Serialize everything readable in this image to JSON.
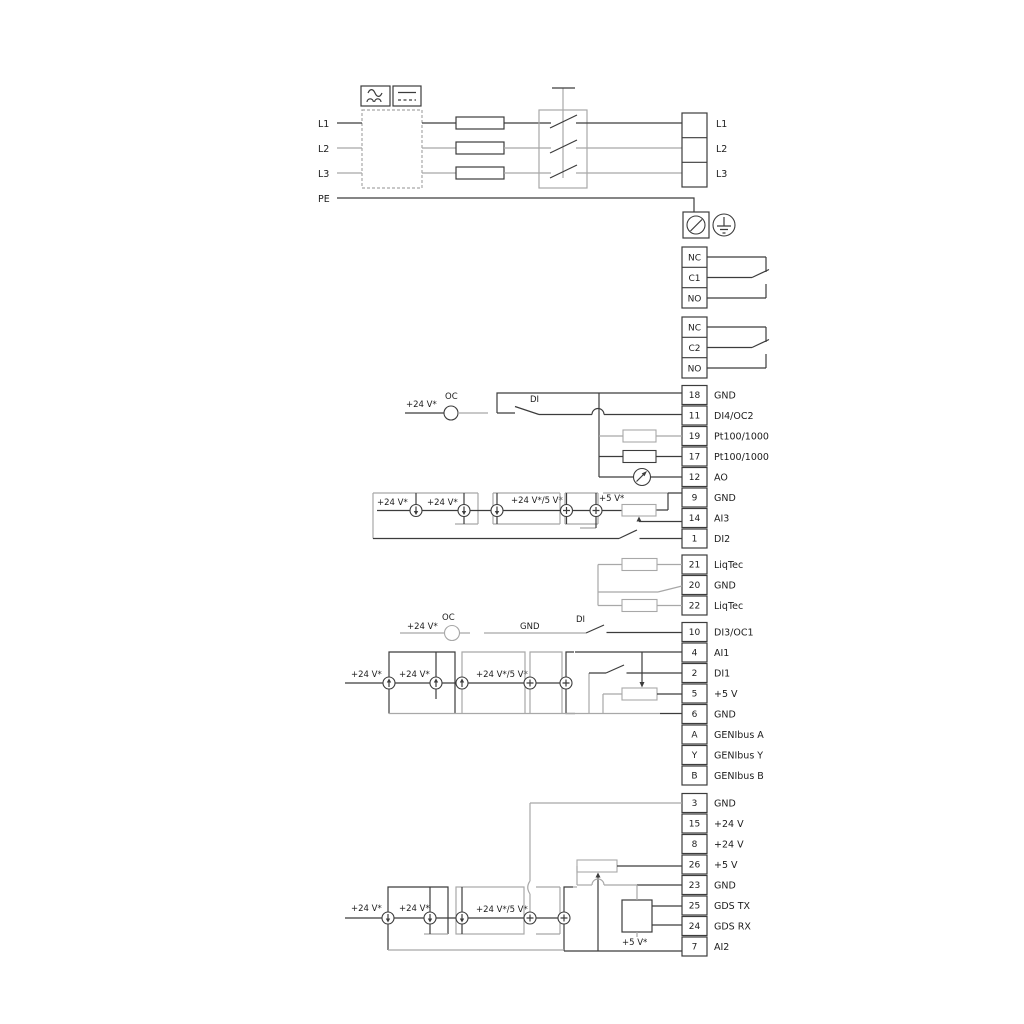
{
  "power": {
    "left_labels": [
      "L1",
      "L2",
      "L3",
      "PE"
    ],
    "right_labels": [
      "L1",
      "L2",
      "L3"
    ]
  },
  "relays": {
    "relay1": [
      "NC",
      "C1",
      "NO"
    ],
    "relay2": [
      "NC",
      "C2",
      "NO"
    ]
  },
  "strip_a": [
    {
      "num": "18",
      "label": "GND"
    },
    {
      "num": "11",
      "label": "DI4/OC2"
    },
    {
      "num": "19",
      "label": "Pt100/1000"
    },
    {
      "num": "17",
      "label": "Pt100/1000"
    },
    {
      "num": "12",
      "label": "AO"
    },
    {
      "num": "9",
      "label": "GND"
    },
    {
      "num": "14",
      "label": "AI3"
    },
    {
      "num": "1",
      "label": "DI2"
    }
  ],
  "strip_liqtec": [
    {
      "num": "21",
      "label": "LiqTec"
    },
    {
      "num": "20",
      "label": "GND"
    },
    {
      "num": "22",
      "label": "LiqTec"
    }
  ],
  "strip_b": [
    {
      "num": "10",
      "label": "DI3/OC1"
    },
    {
      "num": "4",
      "label": "AI1"
    },
    {
      "num": "2",
      "label": "DI1"
    },
    {
      "num": "5",
      "label": "+5 V"
    },
    {
      "num": "6",
      "label": "GND"
    },
    {
      "num": "A",
      "label": "GENIbus A"
    },
    {
      "num": "Y",
      "label": "GENIbus Y"
    },
    {
      "num": "B",
      "label": "GENIbus B"
    }
  ],
  "strip_c": [
    {
      "num": "3",
      "label": "GND"
    },
    {
      "num": "15",
      "label": "+24 V"
    },
    {
      "num": "8",
      "label": "+24 V"
    },
    {
      "num": "26",
      "label": "+5 V"
    },
    {
      "num": "23",
      "label": "GND"
    },
    {
      "num": "25",
      "label": "GDS TX"
    },
    {
      "num": "24",
      "label": "GDS RX"
    },
    {
      "num": "7",
      "label": "AI2"
    }
  ],
  "annotations": {
    "plus24v": "+24 V*",
    "plus24v5v": "+24 V*/5 V*",
    "plus5v": "+5 V*",
    "oc": "OC",
    "di": "DI",
    "gnd": "GND"
  },
  "colors": {
    "wire_dark": "#3c3c3c",
    "wire_gray": "#a8a8a8",
    "text": "#1c1c1c"
  }
}
